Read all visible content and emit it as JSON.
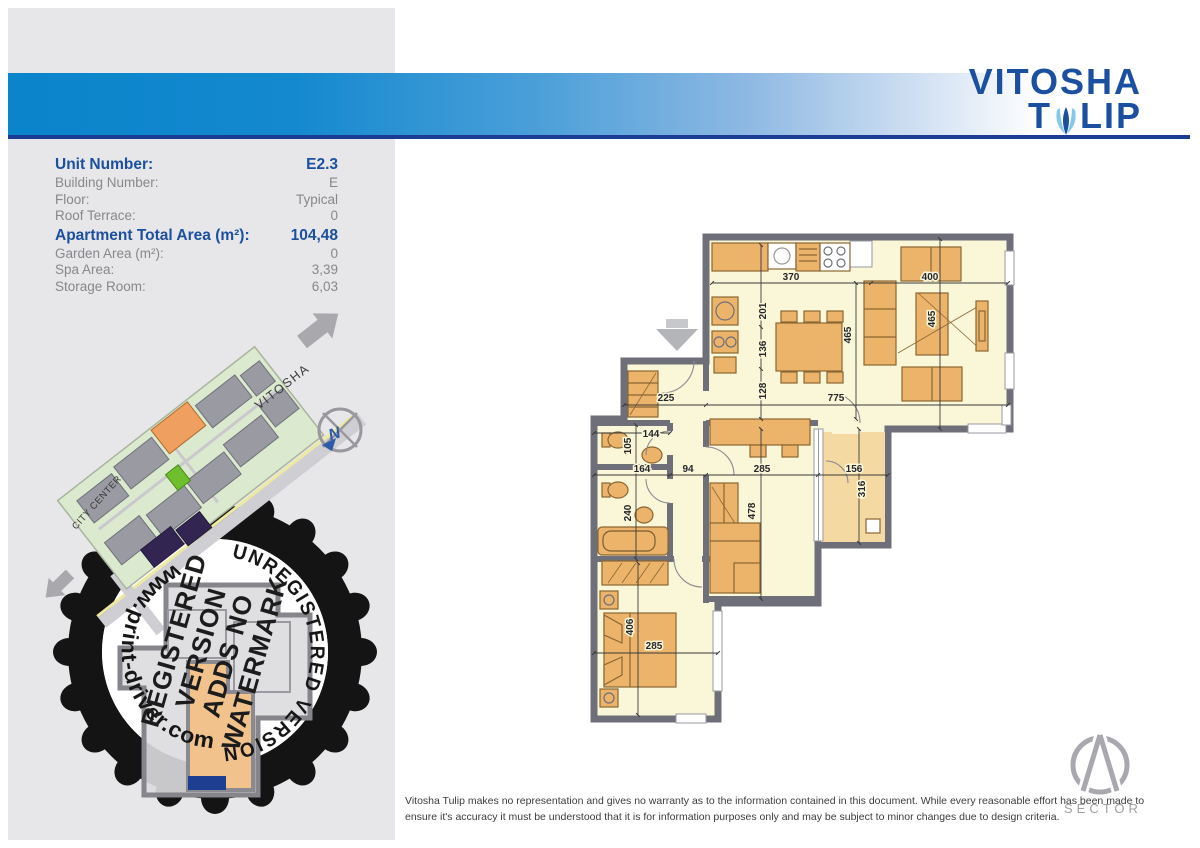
{
  "logo": {
    "line1": "VITOSHA",
    "line2_pre": "T",
    "line2_post": "LIP"
  },
  "specs": {
    "rows": [
      {
        "label": "Unit Number:",
        "value": "E2.3"
      },
      {
        "label": "Building Number:",
        "value": "E"
      },
      {
        "label": "Floor:",
        "value": "Typical"
      },
      {
        "label": "Roof Terrace:",
        "value": "0"
      },
      {
        "label": "Apartment Total Area (m²):",
        "value": "104,48"
      },
      {
        "label": "Garden Area (m²):",
        "value": "0"
      },
      {
        "label": "Spa Area:",
        "value": "3,39"
      },
      {
        "label": "Storage Room:",
        "value": "6,03"
      }
    ]
  },
  "map": {
    "vitosha_label": "VITOSHA",
    "city_center_label": "CITY CENTER",
    "compass_n": "N"
  },
  "watermark": {
    "arc_top": "UNREGISTERED VERSION",
    "arc_left": "www.print-driver.com",
    "block_lines": [
      "REGISTERED",
      "VERSION",
      "ADDS NO",
      "WATERMARK"
    ]
  },
  "plan": {
    "dims": [
      "370",
      "400",
      "201",
      "136",
      "465",
      "465",
      "225",
      "775",
      "128",
      "144",
      "105",
      "164",
      "94",
      "285",
      "156",
      "240",
      "478",
      "316",
      "406",
      "285"
    ]
  },
  "footer": {
    "disclaimer": "Vitosha Tulip makes no representation and gives no warranty as to the information contained in this document. While every reasonable effort has been made to ensure it's accuracy it must be understood that it is for information purposes only and may be subject to minor changes due to design criteria.",
    "brand": "SECTOR"
  },
  "colors": {
    "accent_blue": "#1b4f9f",
    "header_blue": "#0a84cb",
    "underline_navy": "#1c3b92",
    "panel_gray": "#e7e7e9",
    "wall_gray": "#6f6f79",
    "floor_yellow": "#faf7d8",
    "furniture_orange": "#ecb36b",
    "balcony_tan": "#f5d9a2",
    "highlight_orange": "#efa061"
  }
}
